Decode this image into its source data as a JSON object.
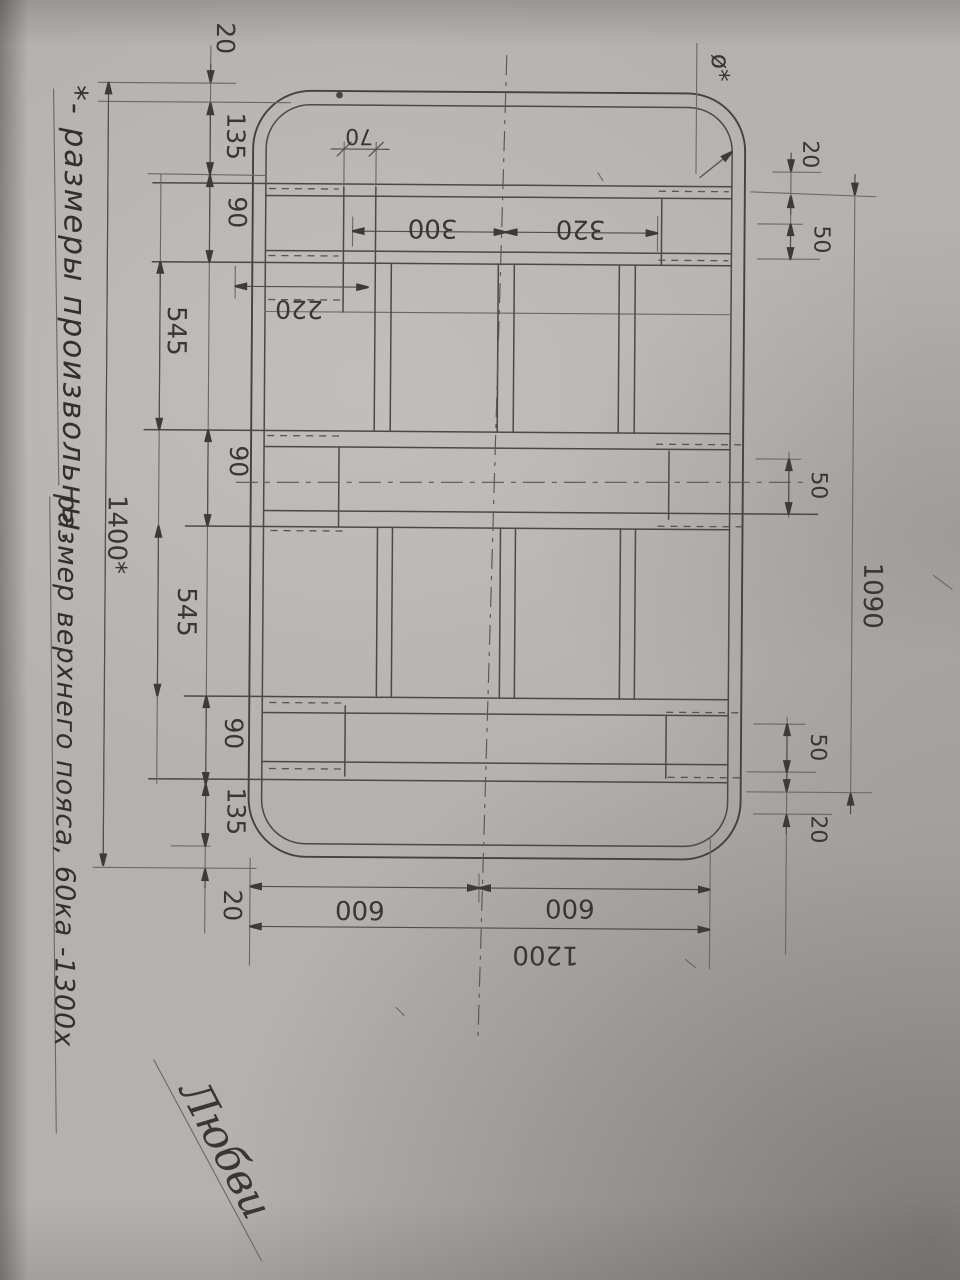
{
  "colors": {
    "paper": "#b5b1ae",
    "pencil": "#45413d"
  },
  "note": {
    "line1": "*- размеры произвольны.",
    "line2": "размер верхнего пояса, 60ка -1300х"
  },
  "signature": "Любви",
  "labels": {
    "corner_diameter": "ø*"
  },
  "dimensions": {
    "left_chain": [
      "20",
      "135",
      "90",
      "545",
      "90",
      "545",
      "90",
      "135",
      "20"
    ],
    "overall_length": "1400*",
    "overall_width": "1090",
    "right_top_offset": "20",
    "right_top_tube": "50",
    "right_mid_gap": "50",
    "right_bottom_tube": "50",
    "right_bottom_offset": "20",
    "stringer_width": "70",
    "first_stringer_offset": "220",
    "stringer_spacing_1": "300",
    "stringer_spacing_2": "320",
    "bottom_half_1": "600",
    "bottom_half_2": "600",
    "bottom_overall": "1200"
  }
}
